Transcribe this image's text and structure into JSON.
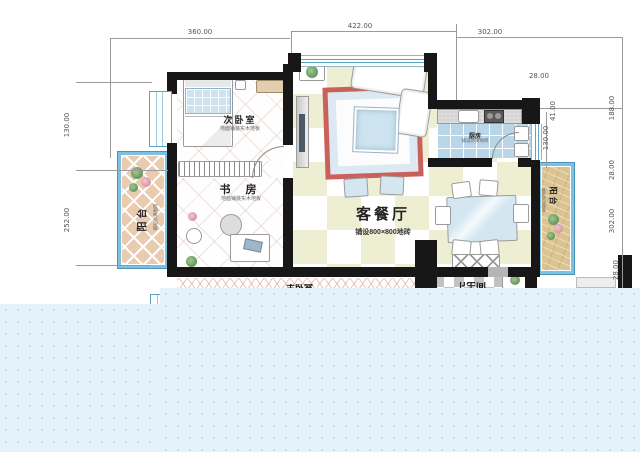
{
  "rooms": {
    "living_dining": {
      "label": "客餐厅",
      "sublabel": "铺设800×800地砖"
    },
    "study": {
      "label": "书 房",
      "sublabel": "地面铺装实木地板"
    },
    "bedroom2": {
      "label": "次卧室",
      "sublabel": "地面铺装实木地板"
    },
    "balcony_left": {
      "label": "阳台",
      "sublabel": "铺贴防滑地砖"
    },
    "balcony_right": {
      "label": "阳台",
      "sublabel": "铺贴防滑地砖"
    },
    "kitchen": {
      "label": "厨房",
      "sublabel": "铺设防滑地砖"
    },
    "clipped_bottom_left": {
      "label": "主卧室"
    },
    "clipped_bottom_right": {
      "label": "卫生间"
    }
  },
  "dimensions": {
    "top_left": "360.00",
    "top_middle": "422.00",
    "top_right": "302.00",
    "left_upper": "130.00",
    "left_lower": "252.00",
    "right_top": "28.00",
    "right_inner_width": "41.00",
    "right_inner_height": "130.00",
    "right_upper": "188.00",
    "right_middle": "302.00",
    "right_bottom": "28.00"
  },
  "colors": {
    "wall": "#171717",
    "window_blue": "#5ba4c9",
    "checker_tan": "#eeeed2",
    "kitchen_tile": "#b9d6e8",
    "balcony_left_fill": "#e9cbb0",
    "balcony_right_fill": "#dbc392",
    "water": "#e3f3f9",
    "rug_border": "#c9605a",
    "dimension_line": "#9a9a9a"
  }
}
